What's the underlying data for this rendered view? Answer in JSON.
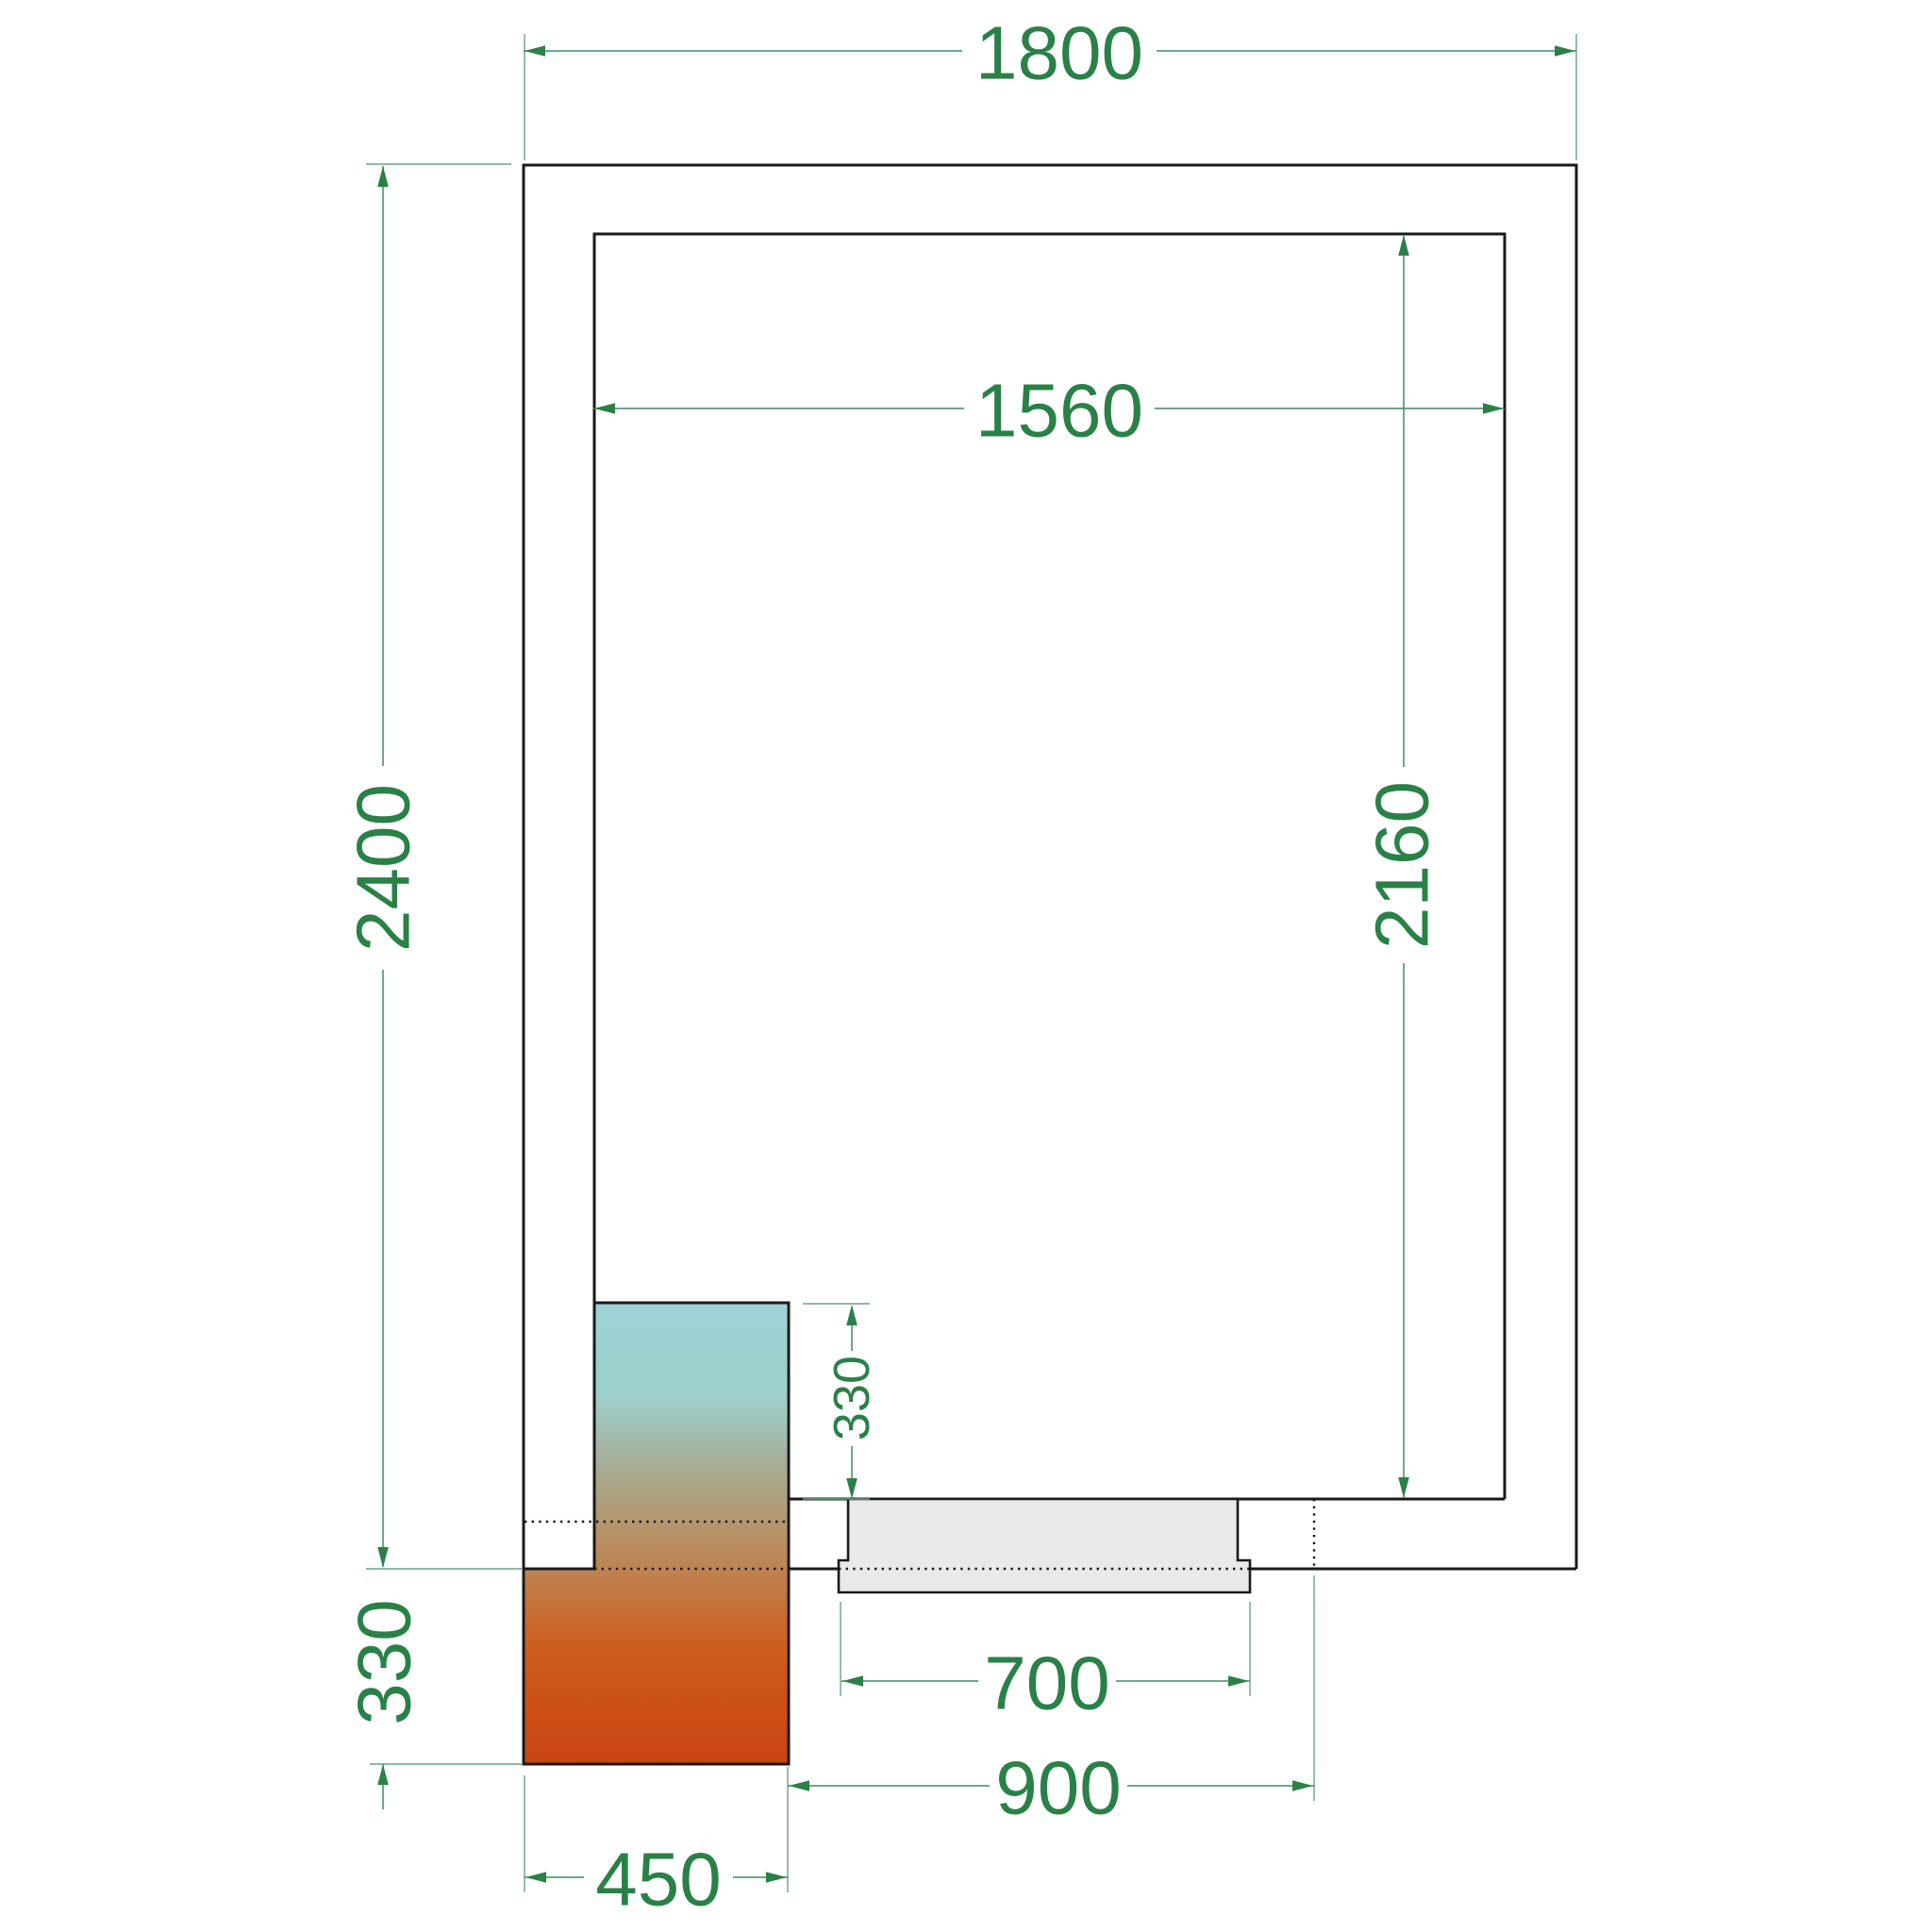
{
  "drawing": {
    "type": "cold-room-floor-plan",
    "labels": {
      "outer_width": "1800",
      "outer_depth": "2400",
      "inner_width": "1560",
      "inner_depth": "2160",
      "unit_depth_inside": "330",
      "unit_depth_outside": "330",
      "door_leaf_width": "700",
      "door_opening_width": "900",
      "unit_width": "450"
    },
    "colors": {
      "dimension_green": "#2a8148",
      "dimension_line_green": "#3f8b60",
      "extension_line_green": "#6aa385",
      "wall_black": "#1a1a1a",
      "door_gray": "#e9e9e9",
      "unit_gradient": [
        "#9ed2d5",
        "#9cd0cd",
        "#a9a78c",
        "#b79367",
        "#c37a45",
        "#cd5d1e",
        "#c94412"
      ]
    }
  }
}
